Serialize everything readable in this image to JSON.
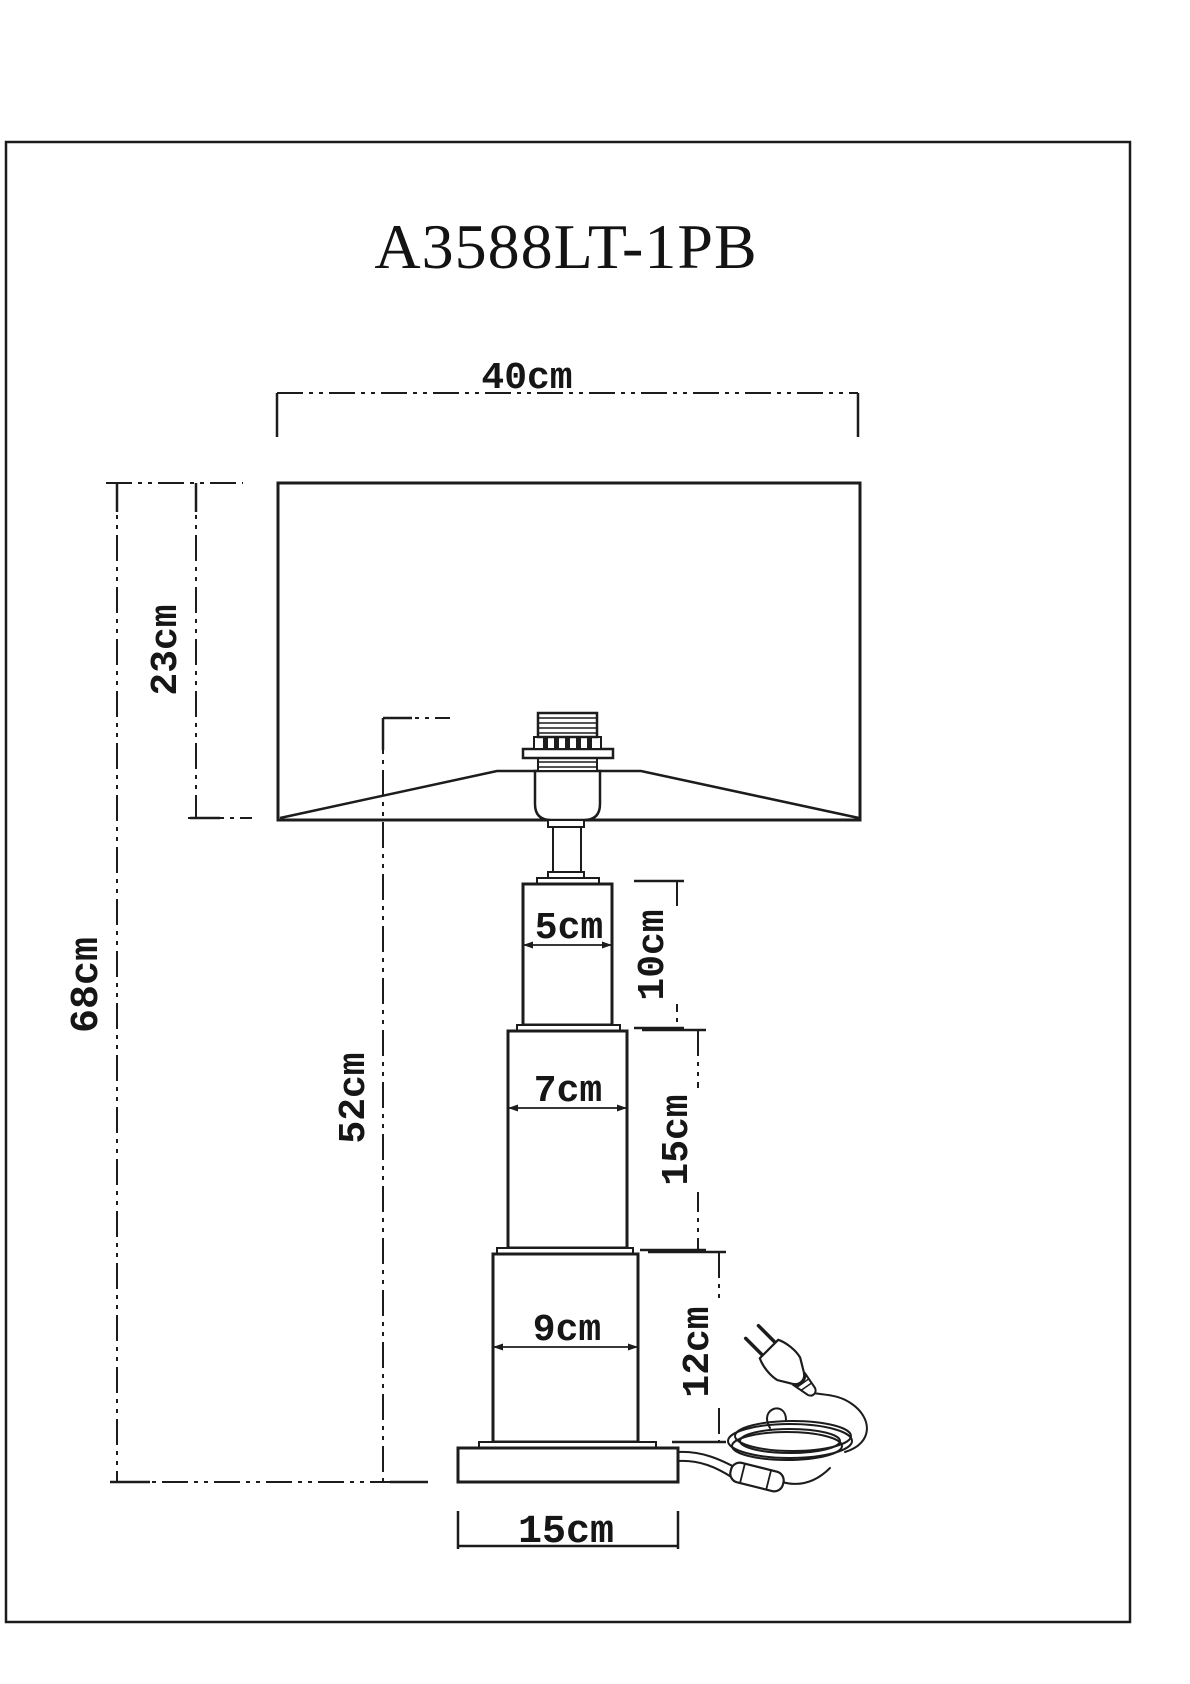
{
  "title": "A3588LT-1PB",
  "dims": {
    "shade_width": "40cm",
    "shade_height": "23cm",
    "total_height": "68cm",
    "body_height": "52cm",
    "upper_column_width": "5cm",
    "upper_column_height": "10cm",
    "middle_column_width": "7cm",
    "middle_column_height": "15cm",
    "lower_column_width": "9cm",
    "lower_column_height": "12cm",
    "base_width": "15cm"
  },
  "colors": {
    "line": "#1c1c1c",
    "background": "#ffffff"
  }
}
